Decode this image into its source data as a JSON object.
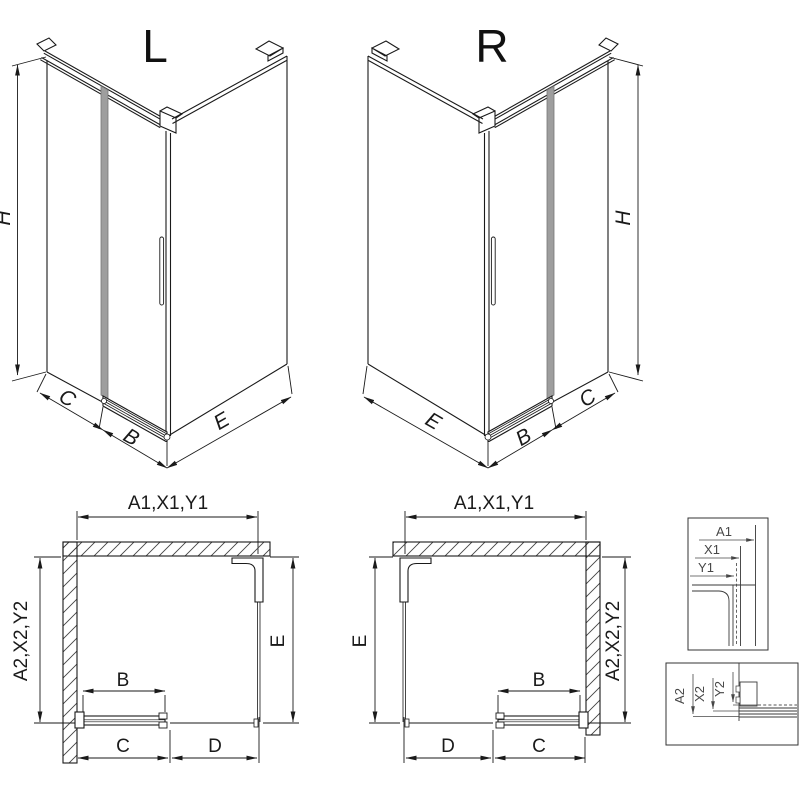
{
  "iso_left": {
    "title": "L",
    "height": "H",
    "seg_left": "C",
    "seg_door": "B",
    "seg_right": "E"
  },
  "iso_right": {
    "title": "R",
    "height": "H",
    "seg_left": "E",
    "seg_door": "B",
    "seg_right": "C"
  },
  "plan_left": {
    "width_top": "A1,X1,Y1",
    "depth_side": "A2,X2,Y2",
    "door": "B",
    "bottom_left": "C",
    "bottom_right": "D",
    "side": "E"
  },
  "plan_right": {
    "width_top": "A1,X1,Y1",
    "depth_side": "A2,X2,Y2",
    "door": "B",
    "bottom_left": "D",
    "bottom_right": "C",
    "side": "E"
  },
  "detail_top": {
    "outer": "A1",
    "mid": "X1",
    "inner": "Y1"
  },
  "detail_bottom": {
    "outer": "A2",
    "mid": "X2",
    "inner": "Y2"
  },
  "colors": {
    "line": "#1a1a1a",
    "thin_line": "#555555",
    "label": "#1a1a1a",
    "detail_label": "#474747",
    "glass_shade": "#9e9e9e",
    "background": "#ffffff"
  }
}
